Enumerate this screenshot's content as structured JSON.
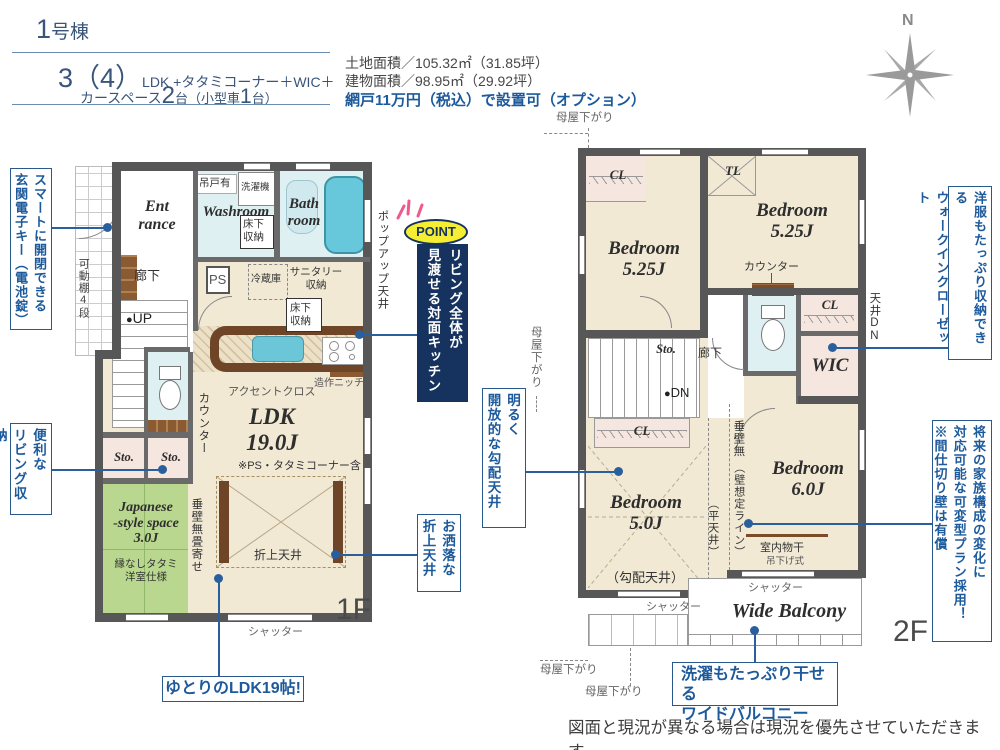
{
  "header": {
    "building_num": "1",
    "building_suffix": "号棟",
    "plan_big": "3（4）",
    "plan_rest": "LDK +タタミコーナー＋WIC＋",
    "plan2_pre": "カースペース",
    "plan2_n1": "2",
    "plan2_mid": "台（小型車",
    "plan2_n2": "1",
    "plan2_post": "台）"
  },
  "areas": {
    "land": "土地面積／105.32㎡（31.85坪）",
    "building": "建物面積／98.95㎡（29.92坪）",
    "option": "網戸11万円（税込）で設置可（オプション）"
  },
  "compass": {
    "north": "N"
  },
  "floor1": {
    "label": "1F",
    "entrance": "Ent\nrance",
    "hallway": "廊下",
    "up": "UP",
    "movable_shelf": "可動棚4段",
    "washroom": "Washroom",
    "hanging_cupboard": "吊戸有",
    "washing_machine": "洗濯機",
    "underfloor_storage1": "床下\n収納",
    "bathroom": "Bath\nroom",
    "ps": "PS",
    "fridge": "冷蔵庫",
    "sanitary_storage": "サニタリー\n収納",
    "underfloor_storage2": "床下\n収納",
    "popup_ceiling": "ポップアップ天井",
    "niche": "造作ニッチ",
    "accent_cloth": "アクセントクロス",
    "counter": "カウンター",
    "ldk": "LDK\n19.0J",
    "ldk_note": "※PS・タタミコーナー含",
    "coffered_ceiling": "折上天井",
    "sto1": "Sto.",
    "sto2": "Sto.",
    "japanese_room": "Japanese\n-style space\n3.0J",
    "japanese_note": "縁なしタタミ\n洋室仕様",
    "tarekabe": "垂壁無畳寄せ",
    "shutter": "シャッター"
  },
  "floor2": {
    "label": "2F",
    "bedroom1": "Bedroom\n5.25J",
    "bedroom2": "Bedroom\n5.25J",
    "bedroom3": "Bedroom\n5.0J",
    "bedroom3_note": "（勾配天井）",
    "bedroom4": "Bedroom\n6.0J",
    "cl1": "CL",
    "cl2": "CL",
    "cl3": "CL",
    "tl": "TL",
    "counter": "カウンター",
    "ceiling_dn": "天井DN",
    "wic": "WIC",
    "sto": "Sto.",
    "hallway": "廊下",
    "dn": "DN",
    "tarekabe": "垂壁無",
    "wall_line": "（壁想定ライン）",
    "flat_ceiling": "（平天井）",
    "indoor_drying": "室内物干",
    "hanging_type": "吊下げ式",
    "shutter1": "シャッター",
    "shutter2": "シャッター",
    "balcony": "Wide Balcony",
    "moya1": "母屋下がり",
    "moya2": "母屋下がり",
    "moya3": "母屋下がり",
    "moya4": "母屋下がり"
  },
  "annotations": {
    "entry_key": "スマートに開閉できる\n玄関電子キー（電池錠）",
    "living_storage": "便利な\nリビング収納",
    "point_label": "POINT",
    "point_text": "リビング全体が\n見渡せる対面キッチン",
    "coffered": "お洒落な\n折上天井",
    "sloped": "明るく\n開放的な勾配天井",
    "wic": "洋服もたっぷり収納できる\nウォークインクローゼット",
    "flexible": "将来の家族構成の変化に\n対応可能な可変型プラン採用！\n※間仕切り壁は有償",
    "ldk19": "ゆとりのLDK19帖!",
    "balcony": "洗濯もたっぷり干せる\nワイドバルコニー"
  },
  "footer": "図面と現況が異なる場合は現況を優先させていただきます。",
  "colors": {
    "annotation_blue": "#1d5a9b",
    "point_navy": "#15335e",
    "point_yellow": "#f6ee33",
    "wall_gray": "#575757",
    "floor_beige": "#f1e9d4",
    "floor_pink": "#f6e6e0",
    "floor_green": "#b9d78f",
    "floor_wet_blue": "#dff0f2",
    "tub_blue": "#66c8da",
    "counter_brown": "#6e4526"
  }
}
